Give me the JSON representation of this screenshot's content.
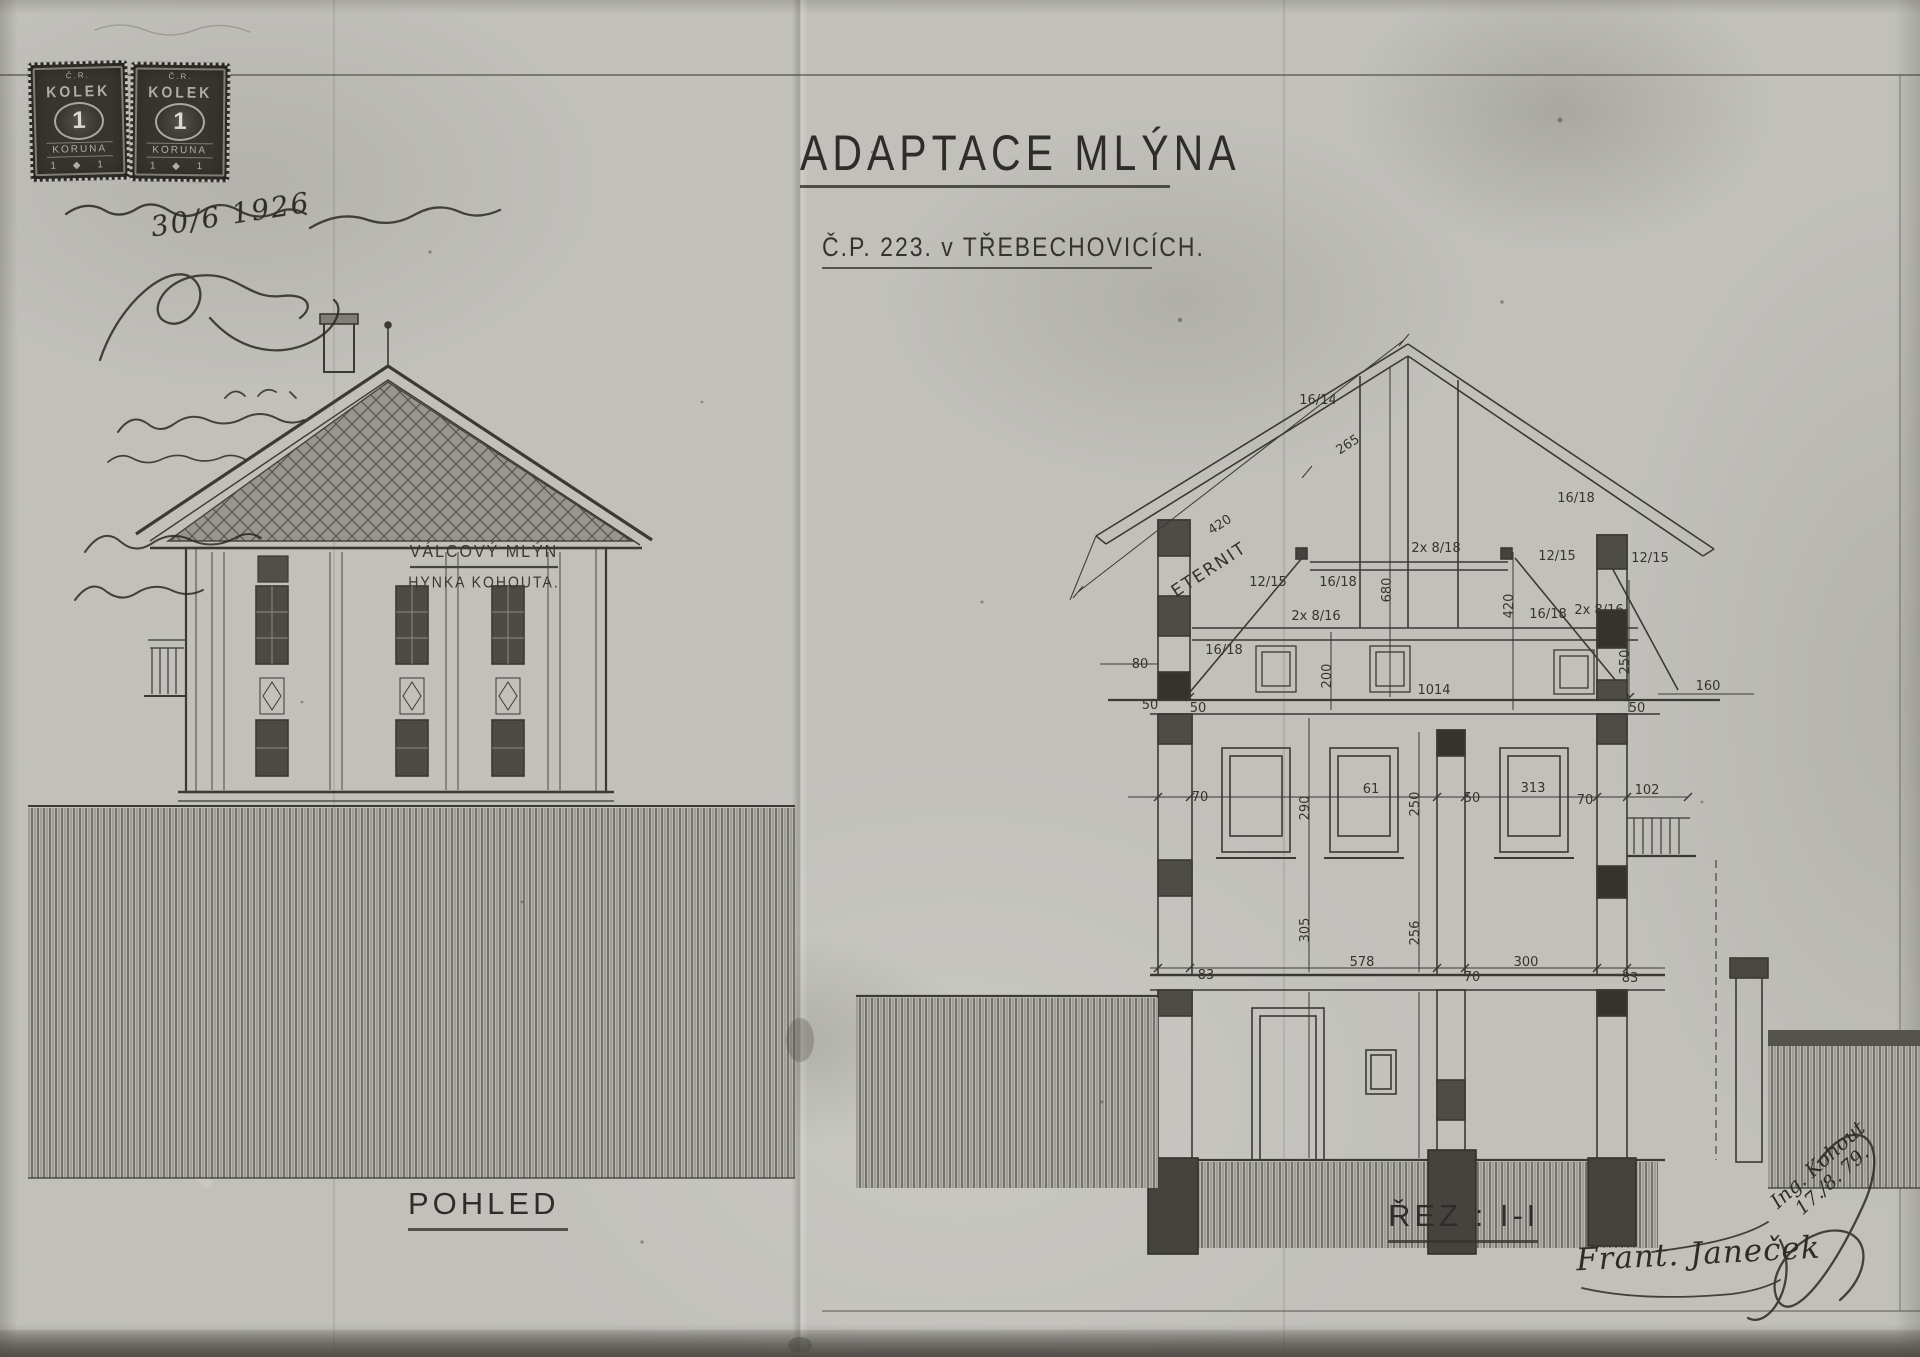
{
  "title_block": {
    "title": "ADAPTACE MLÝNA",
    "subtitle": "Č.P. 223. v TŘEBECHOVICÍCH."
  },
  "stamps": {
    "items": [
      {
        "header": "Č.R.",
        "name": "KOLEK",
        "value": "1",
        "currency": "KORUNA",
        "bottom": "1 ◆ 1"
      },
      {
        "header": "Č.R.",
        "name": "KOLEK",
        "value": "1",
        "currency": "KORUNA",
        "bottom": "1 ◆ 1"
      }
    ]
  },
  "handwritten": {
    "date": "30/6 1926",
    "architect_signature": "Frant. Janeček",
    "diagonal_name": "Ing. Kohout",
    "diagonal_date": "17./8. 79."
  },
  "elevation": {
    "label": "POHLED",
    "plaque_line1": "VÁLCOVÝ MLÝN",
    "plaque_line2": "HYNKA KOHOUTA."
  },
  "section": {
    "label": "ŘEZ : I-I",
    "labels": [
      {
        "t": "265",
        "x": 1350,
        "y": 448,
        "r": -33
      },
      {
        "t": "420",
        "x": 1222,
        "y": 528,
        "r": -33
      },
      {
        "t": "ETERNIT",
        "x": 1212,
        "y": 574,
        "r": -33,
        "big": true
      },
      {
        "t": "16/14",
        "x": 1318,
        "y": 404
      },
      {
        "t": "12/15",
        "x": 1268,
        "y": 586
      },
      {
        "t": "16/18",
        "x": 1338,
        "y": 586
      },
      {
        "t": "2x 8/16",
        "x": 1316,
        "y": 620
      },
      {
        "t": "16/18",
        "x": 1224,
        "y": 654
      },
      {
        "t": "2x 8/18",
        "x": 1436,
        "y": 552
      },
      {
        "t": "680",
        "x": 1391,
        "y": 590,
        "r": -90
      },
      {
        "t": "16/18",
        "x": 1576,
        "y": 502
      },
      {
        "t": "12/15",
        "x": 1557,
        "y": 560
      },
      {
        "t": "12/15",
        "x": 1650,
        "y": 562
      },
      {
        "t": "16/18",
        "x": 1548,
        "y": 618
      },
      {
        "t": "2x 8/16",
        "x": 1599,
        "y": 614
      },
      {
        "t": "420",
        "x": 1513,
        "y": 606,
        "r": -90
      },
      {
        "t": "200",
        "x": 1331,
        "y": 676,
        "r": -90
      },
      {
        "t": "250",
        "x": 1629,
        "y": 662,
        "r": -90
      },
      {
        "t": "80",
        "x": 1140,
        "y": 668
      },
      {
        "t": "50",
        "x": 1150,
        "y": 709
      },
      {
        "t": "50",
        "x": 1198,
        "y": 712
      },
      {
        "t": "1014",
        "x": 1434,
        "y": 694
      },
      {
        "t": "50",
        "x": 1637,
        "y": 712
      },
      {
        "t": "160",
        "x": 1708,
        "y": 690
      },
      {
        "t": "70",
        "x": 1200,
        "y": 801
      },
      {
        "t": "290",
        "x": 1309,
        "y": 808,
        "r": -90
      },
      {
        "t": "61",
        "x": 1371,
        "y": 793
      },
      {
        "t": "250",
        "x": 1419,
        "y": 804,
        "r": -90
      },
      {
        "t": "50",
        "x": 1472,
        "y": 802
      },
      {
        "t": "313",
        "x": 1533,
        "y": 792
      },
      {
        "t": "70",
        "x": 1585,
        "y": 804
      },
      {
        "t": "102",
        "x": 1647,
        "y": 794
      },
      {
        "t": "305",
        "x": 1309,
        "y": 930,
        "r": -90
      },
      {
        "t": "256",
        "x": 1419,
        "y": 933,
        "r": -90
      },
      {
        "t": "83",
        "x": 1206,
        "y": 979
      },
      {
        "t": "578",
        "x": 1362,
        "y": 966
      },
      {
        "t": "70",
        "x": 1472,
        "y": 981
      },
      {
        "t": "300",
        "x": 1526,
        "y": 966
      },
      {
        "t": "83",
        "x": 1630,
        "y": 982
      }
    ]
  }
}
